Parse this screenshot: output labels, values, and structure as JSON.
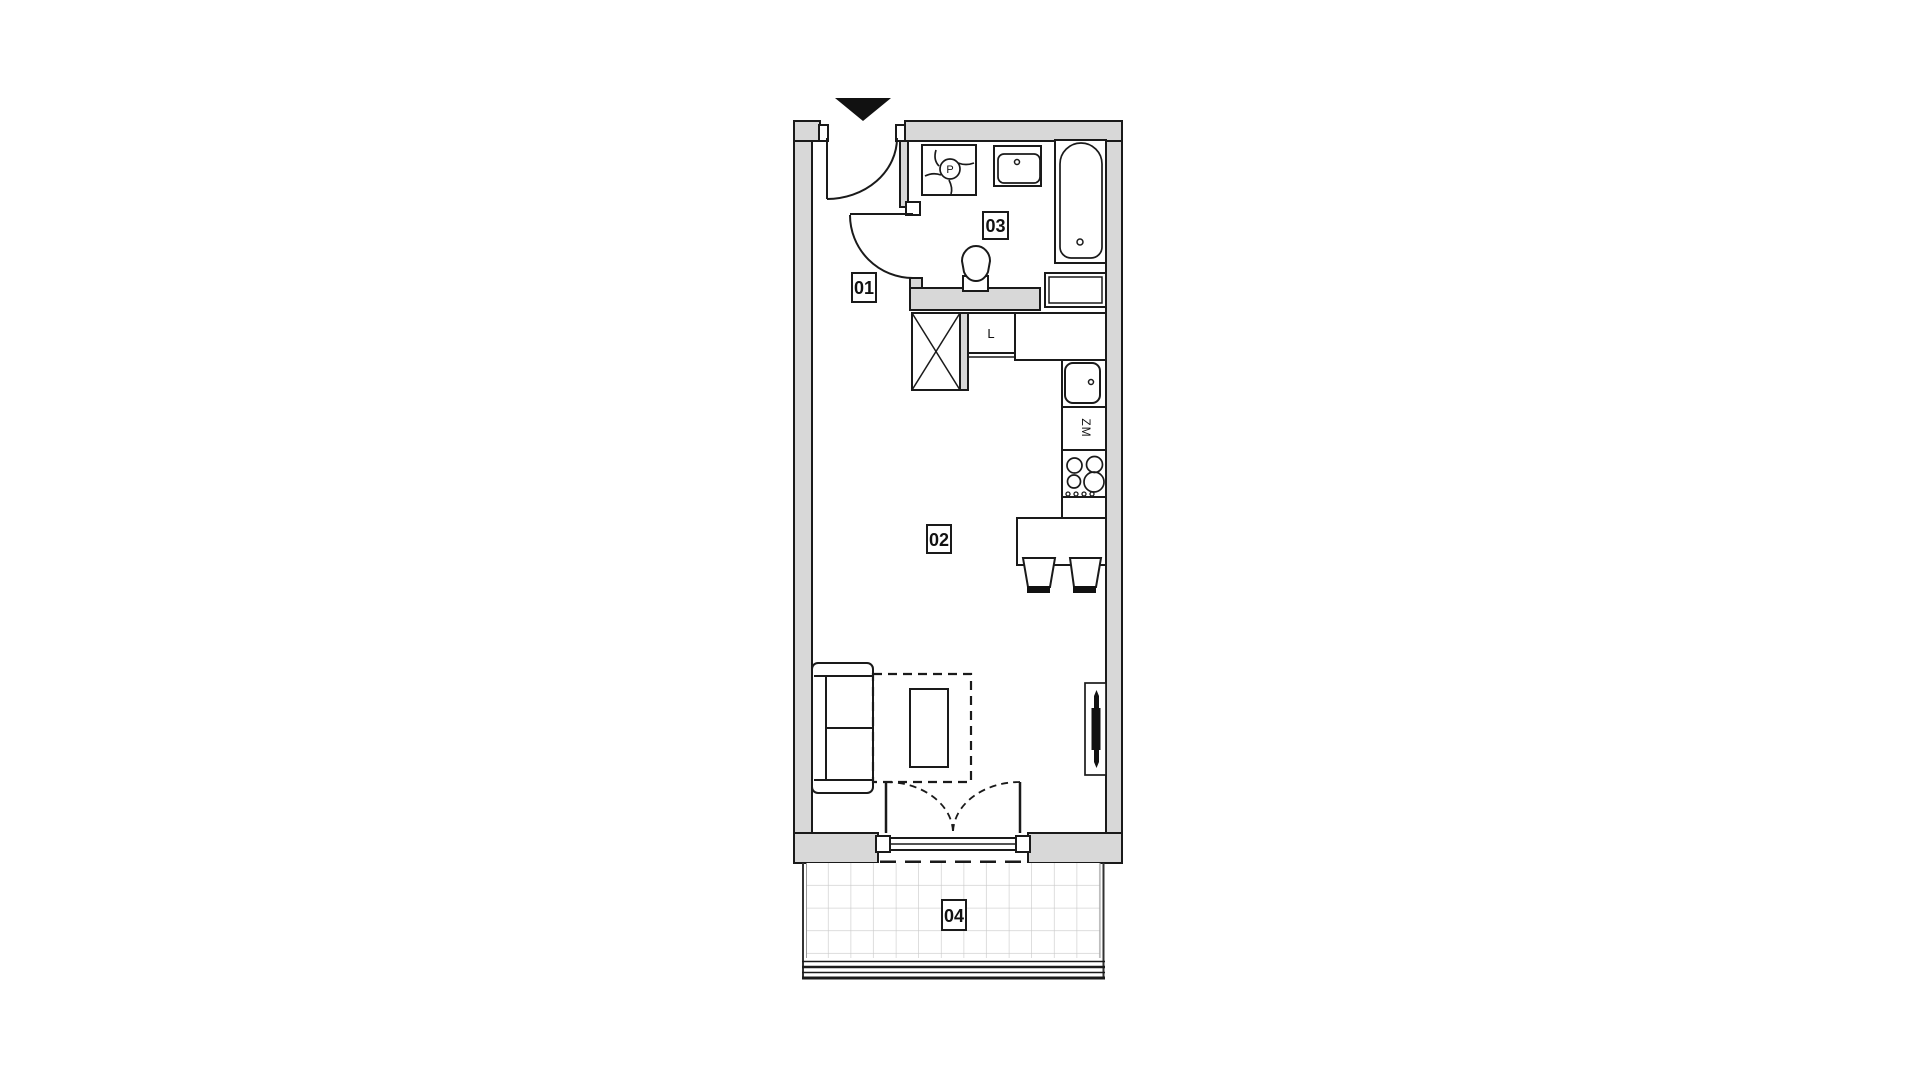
{
  "floor_plan": {
    "labels": {
      "r01": "01",
      "r02": "02",
      "r03": "03",
      "r04": "04",
      "fridge": "L",
      "dishwasher": "ZM",
      "washing_machine": "P"
    },
    "colors": {
      "wall_fill": "#d8d8d8",
      "line": "#1a1a1a",
      "tile_line": "#c9c9c9",
      "entrance_marker": "#111111",
      "furniture_fill": "#ffffff"
    }
  }
}
